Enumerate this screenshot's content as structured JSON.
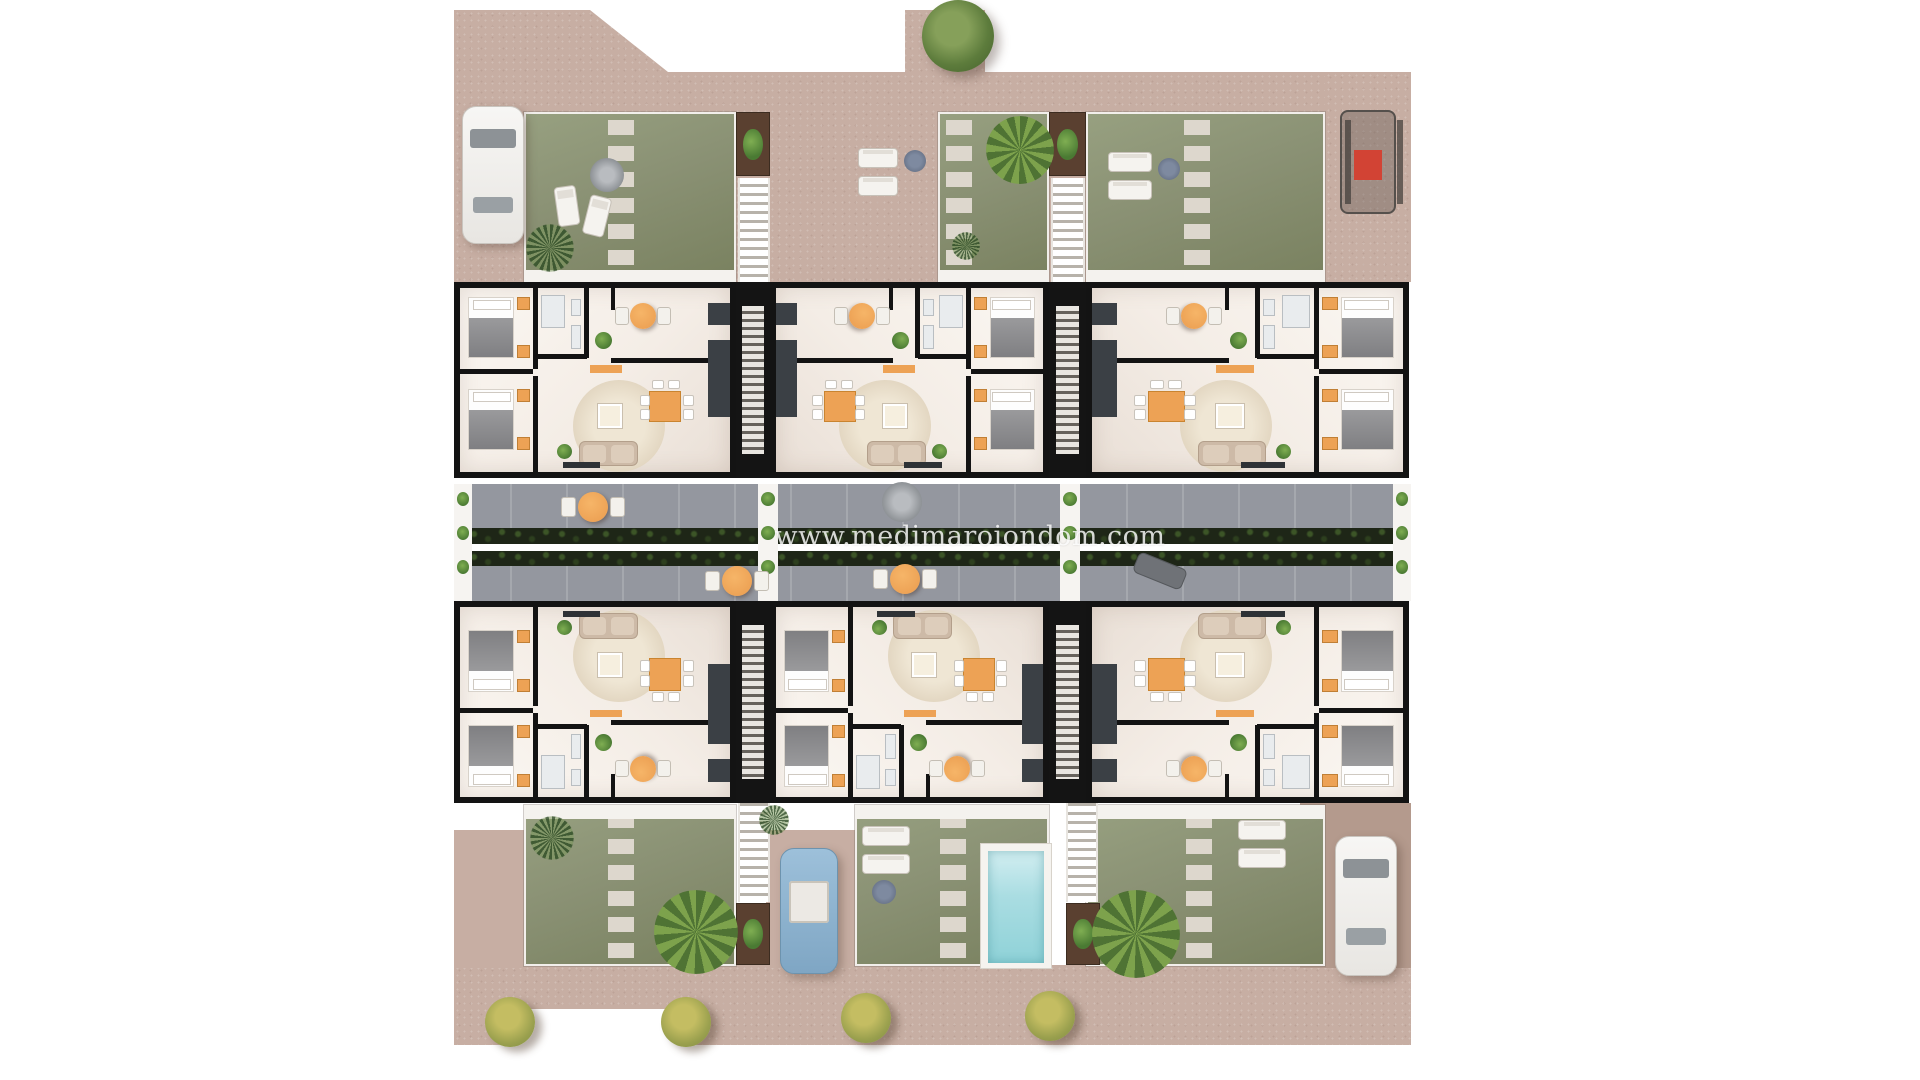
{
  "meta": {
    "description": "Aerial 3D floor-plan rendering of a residential complex: six two-bedroom apartments in three blocks, roof gardens, central landscaped walkway, private pool and parked vehicles",
    "watermark": "www.medimaroiondom.com"
  },
  "palette": {
    "terrain": "#c7aea3",
    "terrain_dark": "#b49a8d",
    "grass": "#8a9174",
    "grass_light": "#97a080",
    "grass_dark": "#79815f",
    "stone": "#ddd7cd",
    "street": "#94979f",
    "hedge": "#1e2617",
    "hedge_leaf": "#3c5527",
    "hedge_leaf2": "#2d3f1e",
    "accent_orange": "#eda255",
    "planter_brown": "#5a4030",
    "leaf": "#4a7a33",
    "leaf_light": "#7fae52",
    "pool_water": "#aadde2",
    "pool_deck": "#f5f3ef",
    "wall_black": "#131313",
    "car_white": "#f2f1ee",
    "car_blue": "#8fb4d4",
    "buggy_red": "#d24334"
  },
  "scene": {
    "units": [
      {
        "id": "unit-top-left",
        "label": "apartment A1",
        "x": 454,
        "y": 282,
        "w": 282,
        "h": 196,
        "flip": ""
      },
      {
        "id": "unit-top-middle",
        "label": "apartment A2",
        "x": 770,
        "y": 282,
        "w": 279,
        "h": 196,
        "flip": "x"
      },
      {
        "id": "unit-top-right",
        "label": "apartment A3",
        "x": 1086,
        "y": 282,
        "w": 323,
        "h": 196,
        "flip": "x"
      },
      {
        "id": "unit-bottom-left",
        "label": "apartment B1",
        "x": 454,
        "y": 601,
        "w": 282,
        "h": 202,
        "flip": "y"
      },
      {
        "id": "unit-bottom-middle",
        "label": "apartment B2",
        "x": 770,
        "y": 601,
        "w": 279,
        "h": 202,
        "flip": "y"
      },
      {
        "id": "unit-bottom-right",
        "label": "apartment B3",
        "x": 1086,
        "y": 601,
        "w": 323,
        "h": 202,
        "flip": "xy"
      }
    ],
    "stairwells": [
      {
        "x": 736,
        "y": 282,
        "w": 34,
        "h": 196
      },
      {
        "x": 1049,
        "y": 282,
        "w": 37,
        "h": 196
      },
      {
        "x": 736,
        "y": 601,
        "w": 34,
        "h": 202
      },
      {
        "x": 1049,
        "y": 601,
        "w": 37,
        "h": 202
      }
    ],
    "outdoor_stairs": [
      {
        "x": 738,
        "y": 178,
        "w": 32,
        "h": 104
      },
      {
        "x": 1051,
        "y": 178,
        "w": 34,
        "h": 104
      },
      {
        "x": 738,
        "y": 788,
        "w": 32,
        "h": 114
      },
      {
        "x": 1066,
        "y": 788,
        "w": 32,
        "h": 114
      }
    ],
    "planters": [
      {
        "x": 736,
        "y": 112,
        "w": 34,
        "h": 64
      },
      {
        "x": 1049,
        "y": 112,
        "w": 37,
        "h": 64
      },
      {
        "x": 736,
        "y": 903,
        "w": 34,
        "h": 62
      },
      {
        "x": 1066,
        "y": 903,
        "w": 34,
        "h": 62
      }
    ],
    "gardens": [
      {
        "x": 524,
        "y": 112,
        "w": 212,
        "h": 170,
        "stones_x": 608,
        "patio": "bottom"
      },
      {
        "x": 938,
        "y": 112,
        "w": 111,
        "h": 170,
        "stones_x": 946,
        "patio": "bottom"
      },
      {
        "x": 1086,
        "y": 112,
        "w": 239,
        "h": 170,
        "stones_x": 1184,
        "patio": "bottom"
      },
      {
        "x": 524,
        "y": 805,
        "w": 212,
        "h": 161,
        "stones_x": 608,
        "patio": "top"
      },
      {
        "x": 855,
        "y": 805,
        "w": 194,
        "h": 161,
        "stones_x": 940,
        "patio": "top"
      },
      {
        "x": 1086,
        "y": 805,
        "w": 239,
        "h": 161,
        "stones_x": 1186,
        "patio": "top"
      }
    ],
    "driveways": [
      {
        "x": 454,
        "y": 830,
        "w": 70,
        "h": 138,
        "dark": false
      },
      {
        "x": 766,
        "y": 830,
        "w": 89,
        "h": 138,
        "dark": false
      },
      {
        "x": 1300,
        "y": 803,
        "w": 111,
        "h": 165,
        "dark": true
      }
    ],
    "street": {
      "terrace_top": {
        "x": 454,
        "y": 484,
        "w": 957,
        "h": 44
      },
      "hedge_top": {
        "x": 466,
        "y": 528,
        "w": 933,
        "h": 16
      },
      "fence": {
        "x": 454,
        "y": 544,
        "w": 957,
        "h": 7
      },
      "hedge_bottom": {
        "x": 466,
        "y": 551,
        "w": 933,
        "h": 15
      },
      "terrace_bottom": {
        "x": 454,
        "y": 566,
        "w": 957,
        "h": 35
      },
      "planter_cols": [
        {
          "x": 454,
          "y": 484,
          "w": 18,
          "h": 117
        },
        {
          "x": 758,
          "y": 484,
          "w": 20,
          "h": 117
        },
        {
          "x": 1060,
          "y": 484,
          "w": 20,
          "h": 117
        },
        {
          "x": 1393,
          "y": 484,
          "w": 18,
          "h": 117
        }
      ]
    },
    "street_furniture": [
      {
        "type": "cafe-table",
        "x": 578,
        "y": 492,
        "d": 30
      },
      {
        "type": "cafe-table",
        "x": 722,
        "y": 566,
        "d": 30
      },
      {
        "type": "cafe-table",
        "x": 890,
        "y": 564,
        "d": 30
      },
      {
        "type": "parasol",
        "x": 882,
        "y": 482,
        "d": 40
      },
      {
        "type": "bench",
        "x": 1134,
        "y": 560,
        "w": 52,
        "h": 22,
        "rot": 22
      }
    ],
    "garden_furniture": [
      {
        "type": "lounger",
        "x": 556,
        "y": 186,
        "w": 22,
        "h": 40,
        "rot": -8
      },
      {
        "type": "lounger",
        "x": 586,
        "y": 196,
        "w": 22,
        "h": 40,
        "rot": 14
      },
      {
        "type": "parasol",
        "x": 590,
        "y": 158,
        "d": 34
      },
      {
        "type": "lounger",
        "x": 858,
        "y": 148,
        "w": 40,
        "h": 20,
        "rot": 0
      },
      {
        "type": "lounger",
        "x": 858,
        "y": 176,
        "w": 40,
        "h": 20,
        "rot": 0
      },
      {
        "type": "side-table",
        "x": 904,
        "y": 150,
        "d": 22
      },
      {
        "type": "lounger",
        "x": 1108,
        "y": 152,
        "w": 44,
        "h": 20,
        "rot": 0
      },
      {
        "type": "lounger",
        "x": 1108,
        "y": 180,
        "w": 44,
        "h": 20,
        "rot": 0
      },
      {
        "type": "side-table",
        "x": 1158,
        "y": 158,
        "d": 22
      },
      {
        "type": "lounger",
        "x": 862,
        "y": 826,
        "w": 48,
        "h": 20,
        "rot": 0
      },
      {
        "type": "lounger",
        "x": 862,
        "y": 854,
        "w": 48,
        "h": 20,
        "rot": 0
      },
      {
        "type": "side-table",
        "x": 872,
        "y": 880,
        "d": 24
      },
      {
        "type": "lounger",
        "x": 1238,
        "y": 820,
        "w": 48,
        "h": 20,
        "rot": 0
      },
      {
        "type": "lounger",
        "x": 1238,
        "y": 848,
        "w": 48,
        "h": 20,
        "rot": 0
      }
    ],
    "pool": {
      "deck": {
        "x": 980,
        "y": 843,
        "w": 72,
        "h": 126
      },
      "water": {
        "x": 988,
        "y": 851,
        "w": 56,
        "h": 112
      }
    },
    "vehicles": [
      {
        "type": "car-white",
        "x": 462,
        "y": 106,
        "w": 62,
        "h": 138
      },
      {
        "type": "buggy",
        "x": 1340,
        "y": 110,
        "w": 56,
        "h": 104
      },
      {
        "type": "car-blue",
        "x": 780,
        "y": 848,
        "w": 58,
        "h": 126
      },
      {
        "type": "car-white",
        "x": 1335,
        "y": 836,
        "w": 62,
        "h": 140
      }
    ],
    "vegetation": [
      {
        "type": "tree",
        "cx": 958,
        "cy": 36,
        "r": 36
      },
      {
        "type": "palm",
        "cx": 1020,
        "cy": 150,
        "r": 34
      },
      {
        "type": "palm",
        "cx": 696,
        "cy": 932,
        "r": 42
      },
      {
        "type": "palm",
        "cx": 1136,
        "cy": 934,
        "r": 44
      },
      {
        "type": "twig",
        "cx": 550,
        "cy": 248,
        "r": 24
      },
      {
        "type": "twig",
        "cx": 552,
        "cy": 838,
        "r": 22
      },
      {
        "type": "twig",
        "cx": 966,
        "cy": 246,
        "r": 14
      },
      {
        "type": "twig",
        "cx": 774,
        "cy": 820,
        "r": 15
      },
      {
        "type": "bush",
        "cx": 510,
        "cy": 1022,
        "r": 25
      },
      {
        "type": "bush",
        "cx": 686,
        "cy": 1022,
        "r": 25
      },
      {
        "type": "bush",
        "cx": 866,
        "cy": 1018,
        "r": 25
      },
      {
        "type": "bush",
        "cx": 1050,
        "cy": 1016,
        "r": 25
      }
    ]
  }
}
